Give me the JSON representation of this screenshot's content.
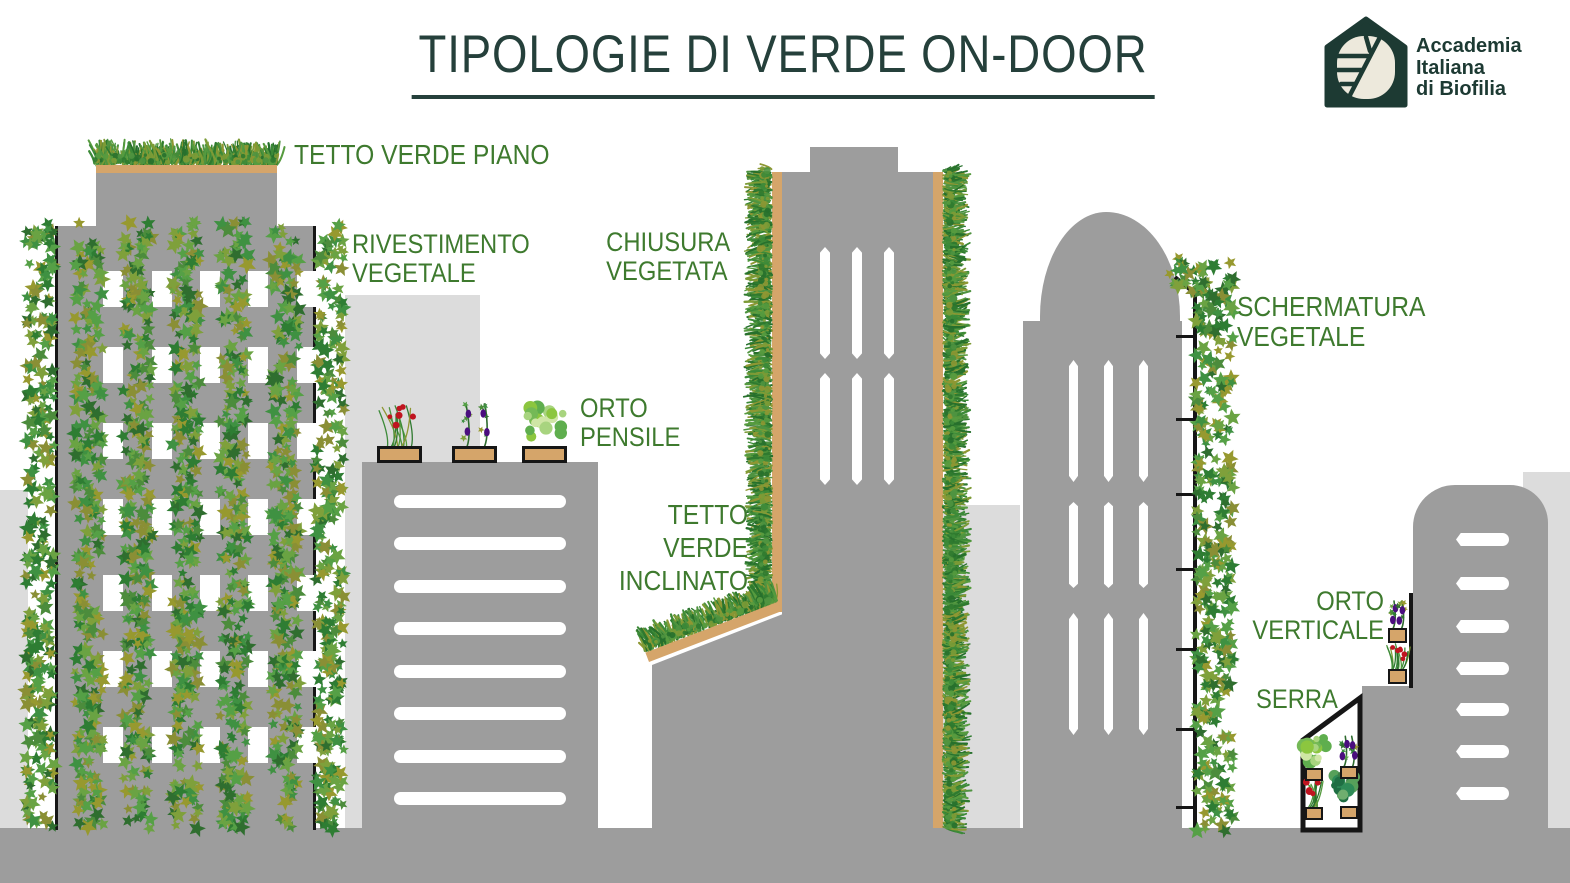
{
  "title": {
    "text": "TIPOLOGIE DI VERDE ON-DOOR"
  },
  "logo": {
    "icon": "house-leaf-mosaic-icon",
    "line1": "Accademia",
    "line2": "Italiana",
    "line3": "di Biofilia"
  },
  "labels": {
    "flat_green_roof": {
      "text": "TETTO VERDE PIANO"
    },
    "vegetal_cladding": {
      "line1": "RIVESTIMENTO",
      "line2": "VEGETALE"
    },
    "hanging_garden": {
      "line1": "ORTO",
      "line2": "PENSILE"
    },
    "vegetated_closure": {
      "line1": "CHIUSURA",
      "line2": "VEGETATA"
    },
    "inclined_green_roof": {
      "line1": "TETTO",
      "line2": "VERDE",
      "line3": "INCLINATO"
    },
    "vegetal_screening": {
      "line1": "SCHERMATURA",
      "line2": "VEGETALE"
    },
    "vertical_garden": {
      "line1": "ORTO",
      "line2": "VERTICALE"
    },
    "greenhouse": {
      "text": "SERRA"
    }
  },
  "colors": {
    "label_green": "#3E7A2E",
    "title_dark": "#25403B",
    "logo_dark": "#1D3A33",
    "building_gray": "#9D9D9D",
    "background_gray": "#DCDCDC",
    "soil_tan": "#D5A56A",
    "frame_black": "#161616",
    "fruit_red": "#C01520",
    "fruit_purple": "#4A0E7E"
  }
}
